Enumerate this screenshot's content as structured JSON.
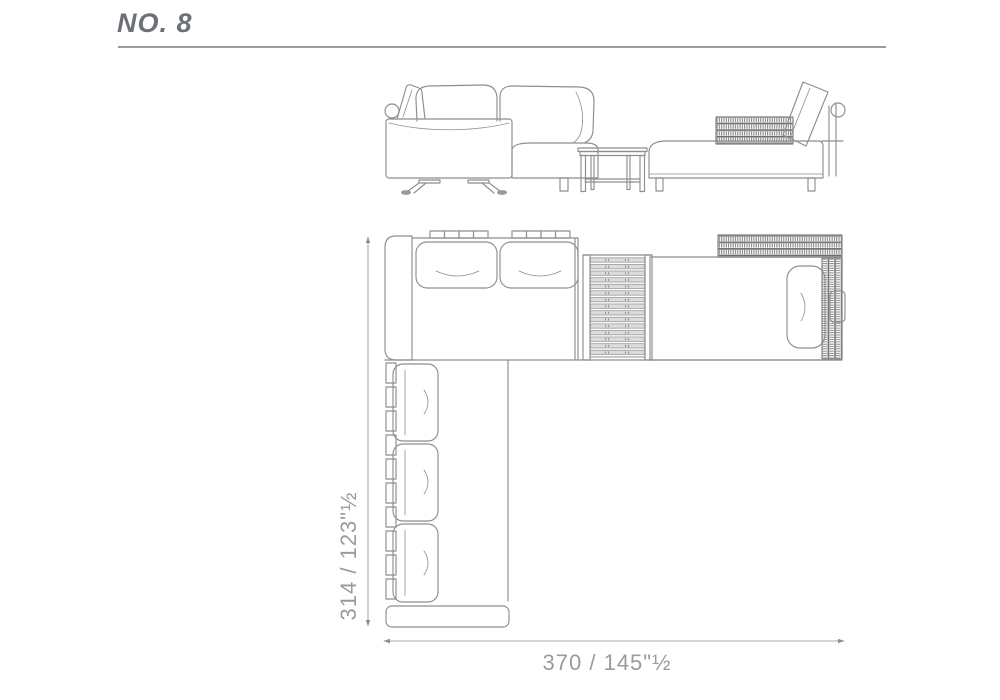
{
  "header": {
    "title": "NO. 8"
  },
  "plan": {
    "dimension_depth": "314 / 123\"½",
    "dimension_width": "370 / 145\"½"
  },
  "colors": {
    "line": "#8e8e8e",
    "dim_text": "#9b9b9b",
    "title_text": "#6d7177",
    "weave": "#6e6e6e",
    "slat_fill": "#dcdcdc",
    "rule": "#9c9c9c",
    "background": "#ffffff"
  }
}
